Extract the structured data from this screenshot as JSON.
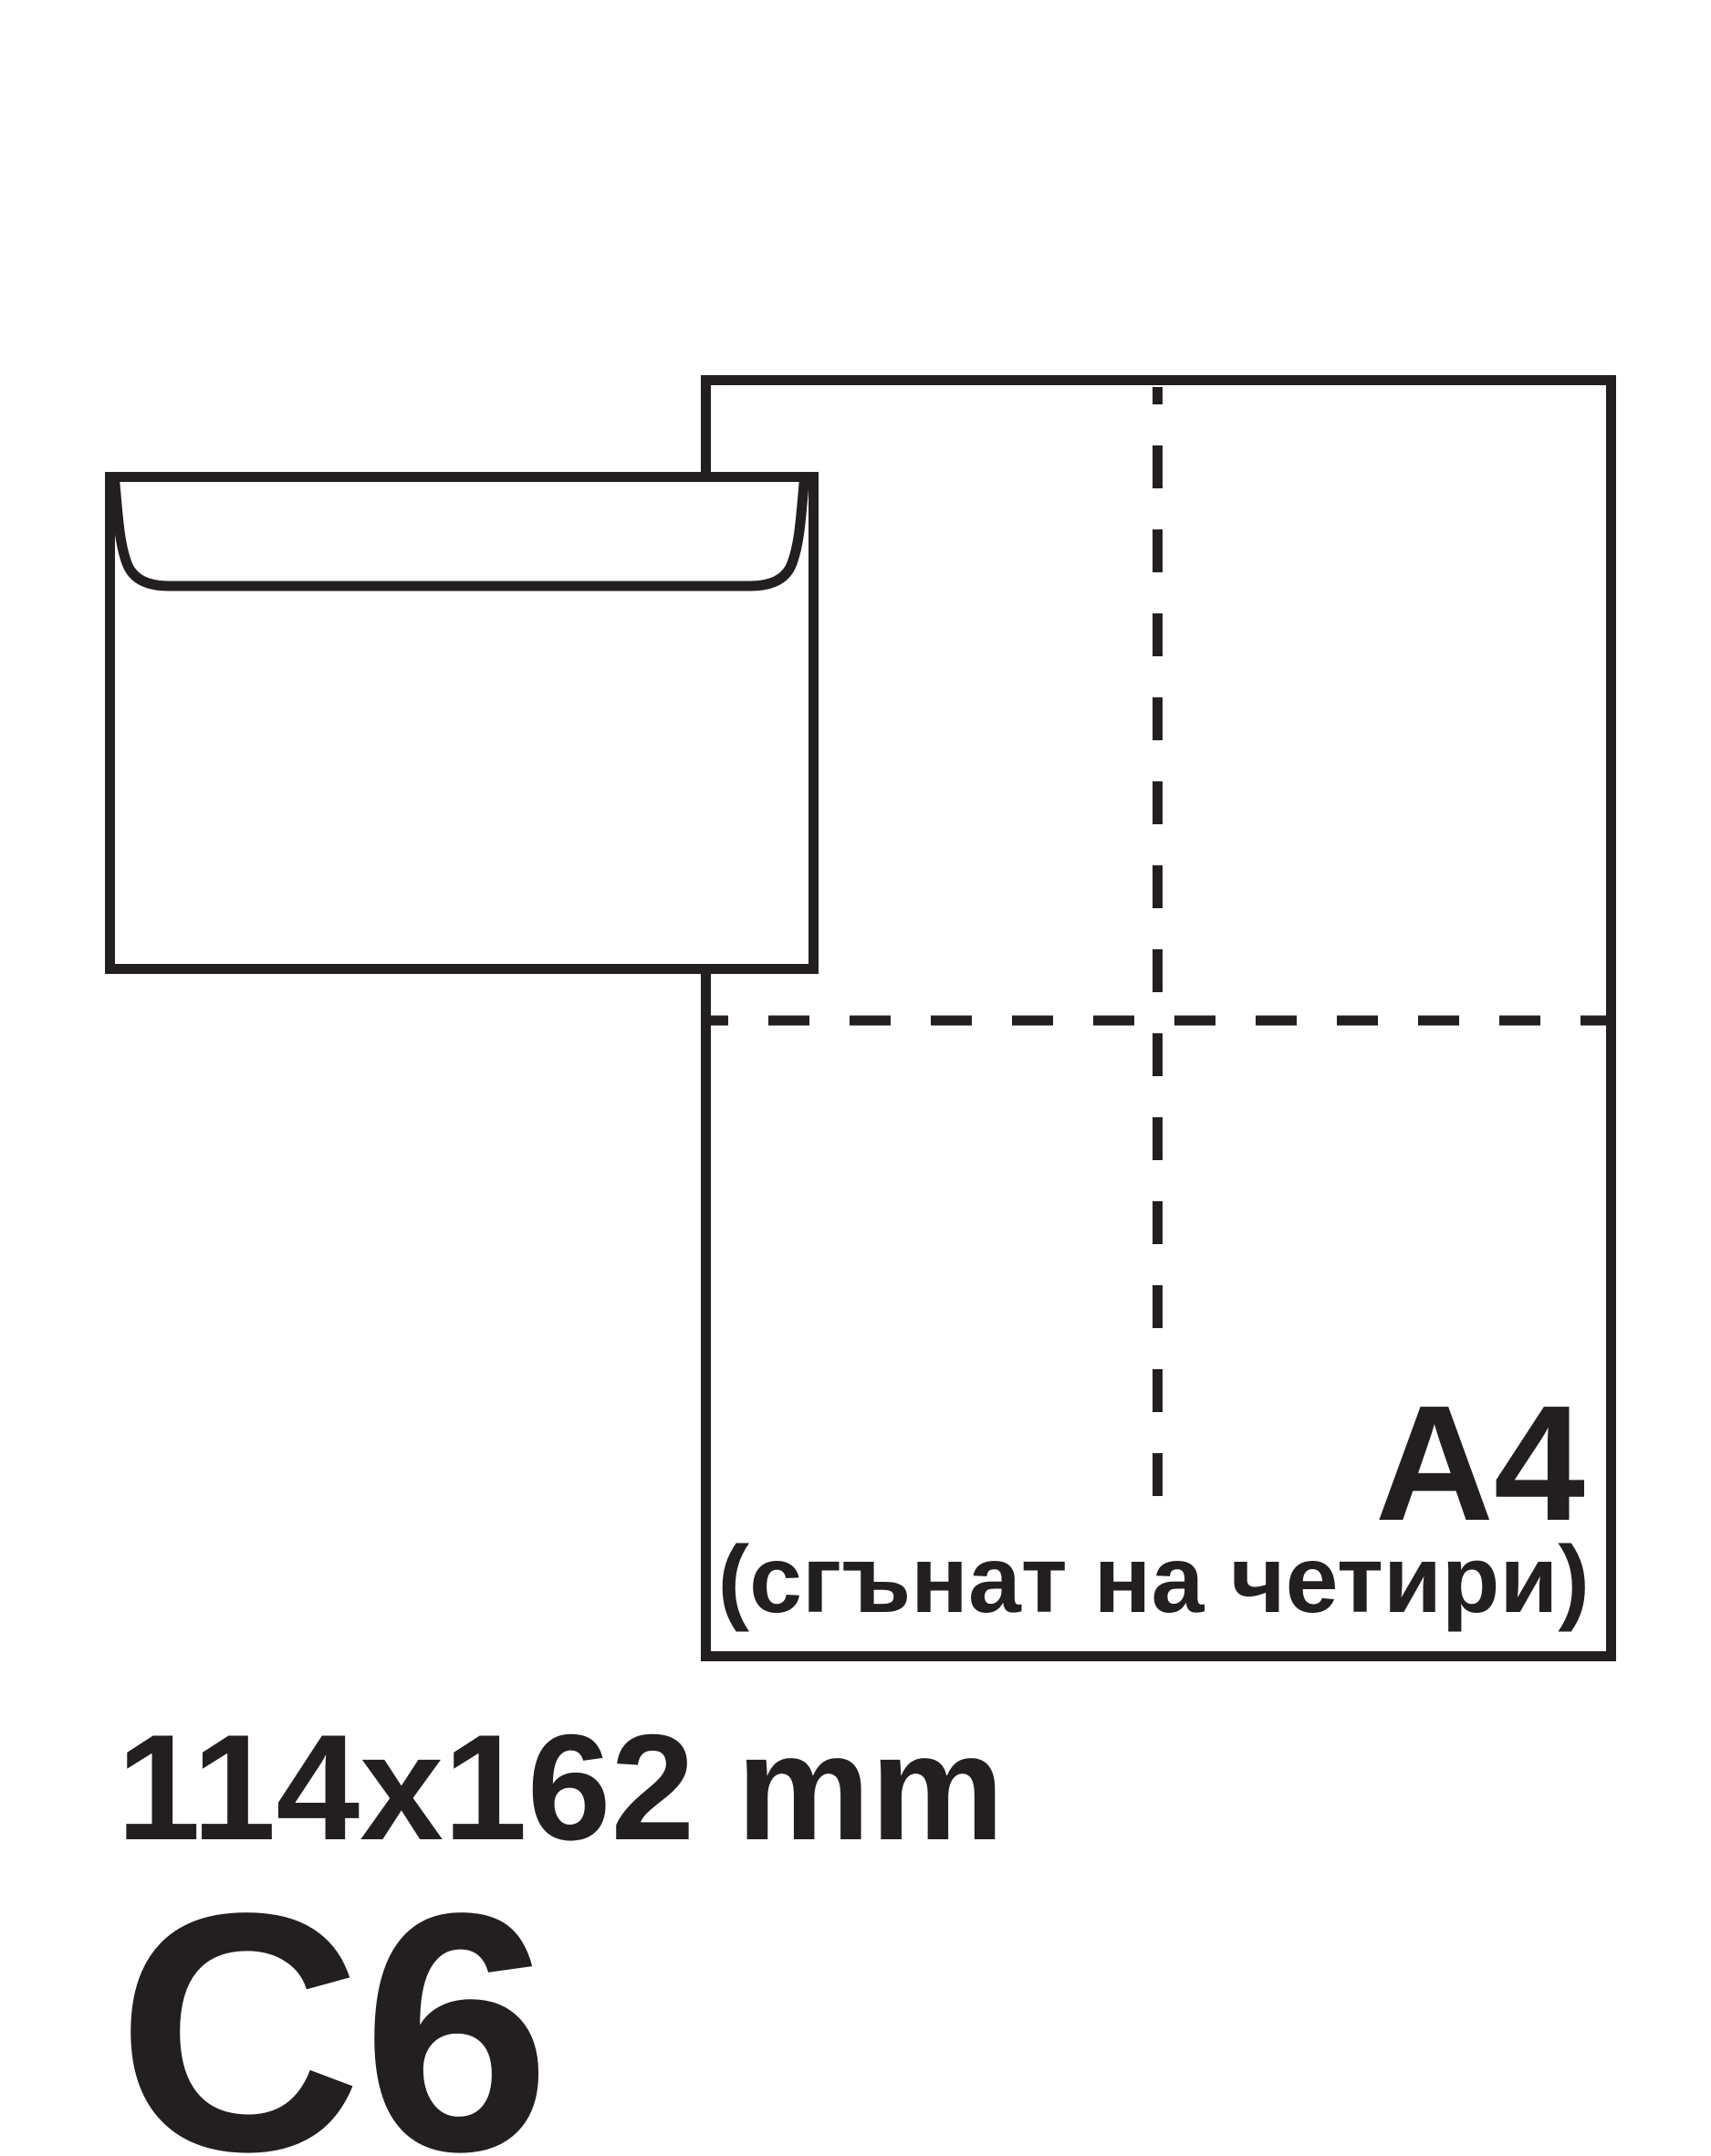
{
  "colors": {
    "background": "#ffffff",
    "ink": "#231f20"
  },
  "labels": {
    "sheet_format": "A4",
    "sheet_note": "(сгънат на четири)",
    "envelope_dimensions": "114x162 mm",
    "envelope_format": "C6"
  }
}
